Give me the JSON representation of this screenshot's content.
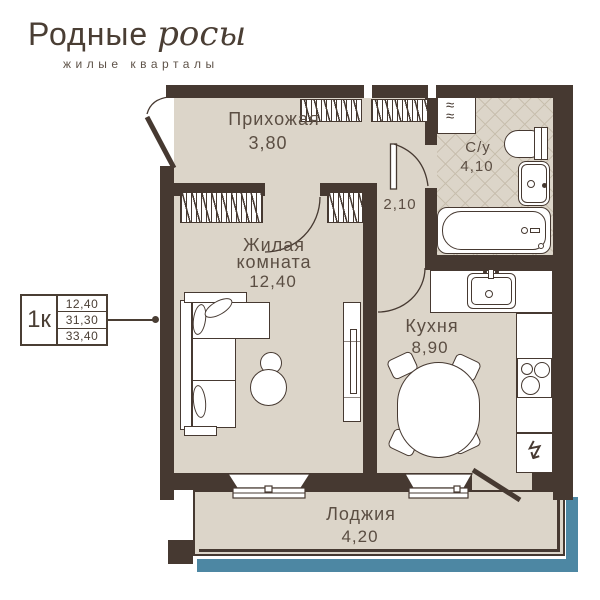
{
  "brand": {
    "name_main": "Родные",
    "name_accent": "росы",
    "tagline": "жилые кварталы"
  },
  "apartment_card": {
    "type": "1к",
    "values": [
      "12,40",
      "31,30",
      "33,40"
    ]
  },
  "rooms": {
    "hallway": {
      "name": "Прихожая",
      "area": "3,80"
    },
    "bathroom": {
      "name": "С/у",
      "area": "4,10"
    },
    "corridor": {
      "area": "2,10"
    },
    "living": {
      "name_line1": "Жилая",
      "name_line2": "комната",
      "area": "12,40"
    },
    "kitchen": {
      "name": "Кухня",
      "area": "8,90"
    },
    "loggia": {
      "name": "Лоджия",
      "area": "4,20"
    }
  },
  "icons": {
    "washing_machine_wave": "≈",
    "fridge_lightning": "↯"
  },
  "colors": {
    "wall": "#463931",
    "floor": "#dcd5c9",
    "tile_line": "#c8bfae",
    "accent": "#4d87a3",
    "label": "#5b4e43"
  }
}
